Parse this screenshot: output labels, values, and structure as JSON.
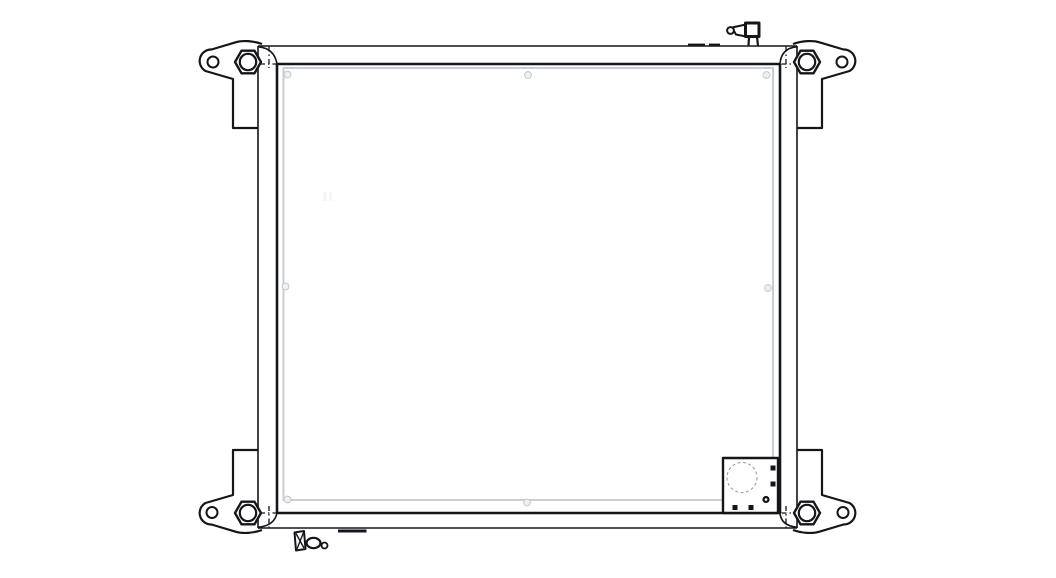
{
  "diagram": {
    "type": "technical-line-drawing",
    "subject": "radiator-frame-assembly-front-view",
    "colors": {
      "background": "#ffffff",
      "line": "#15161a",
      "core_edge": "#c9cdd4",
      "marker_fill": "#eef0f2",
      "marker_stroke": "#c4c8cc",
      "hidden_detail": "#9aa0a8"
    },
    "parts": [
      {
        "id": "core-panel"
      },
      {
        "id": "top-rail"
      },
      {
        "id": "bottom-rail"
      },
      {
        "id": "left-rail"
      },
      {
        "id": "right-rail"
      },
      {
        "id": "mounting-bracket-top-left"
      },
      {
        "id": "mounting-bracket-top-right"
      },
      {
        "id": "mounting-bracket-bottom-left"
      },
      {
        "id": "mounting-bracket-bottom-right"
      },
      {
        "id": "hex-bolt-top-left"
      },
      {
        "id": "hex-bolt-top-right"
      },
      {
        "id": "hex-bolt-bottom-left"
      },
      {
        "id": "hex-bolt-bottom-right"
      },
      {
        "id": "filler-fitting-top"
      },
      {
        "id": "drain-fitting-bottom"
      },
      {
        "id": "connector-box-bottom-right"
      },
      {
        "id": "mounting-tab-top"
      },
      {
        "id": "mounting-tab-bottom"
      }
    ]
  }
}
